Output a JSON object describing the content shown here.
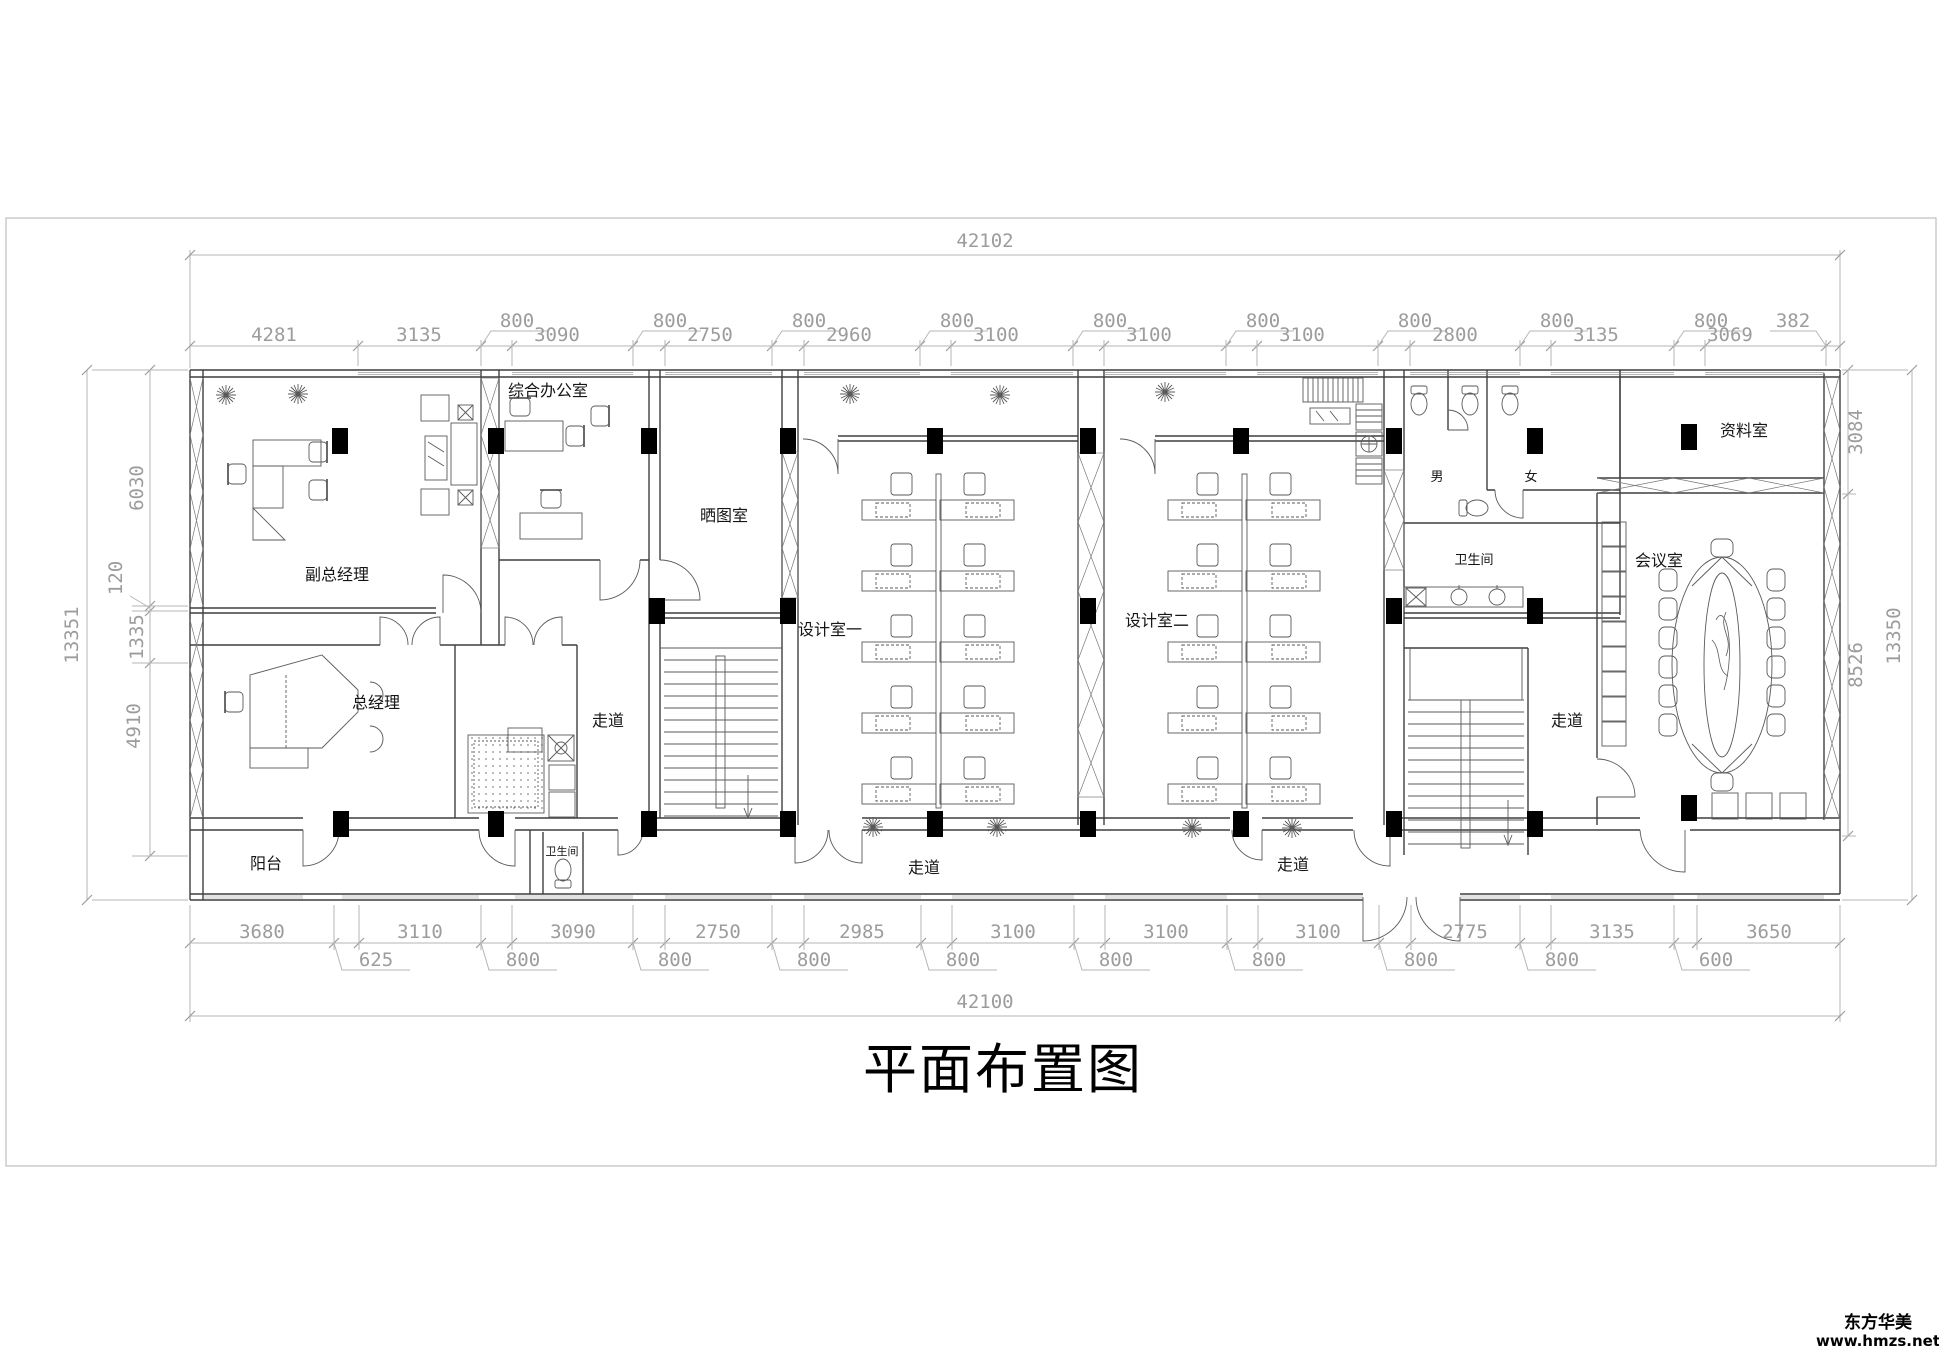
{
  "title": "平面布置图",
  "watermark": {
    "name": "东方华美",
    "url": "www.hmzs.net"
  },
  "dims": {
    "top_total": "42102",
    "bottom_total": "42100",
    "top_main": [
      "4281",
      "3135",
      "3090",
      "2750",
      "2960",
      "3100",
      "3100",
      "3100",
      "2800",
      "3135",
      "3069",
      "382"
    ],
    "top_sub": [
      "800",
      "800",
      "800",
      "800",
      "800",
      "800",
      "800",
      "800",
      "800"
    ],
    "bottom_main": [
      "3680",
      "3110",
      "3090",
      "2750",
      "2985",
      "3100",
      "3100",
      "3100",
      "2775",
      "3135",
      "3650"
    ],
    "bottom_sub": [
      "625",
      "800",
      "800",
      "800",
      "800",
      "800",
      "800",
      "800",
      "800",
      "600"
    ],
    "left_total": "13351",
    "left_chain": [
      "6030",
      "120",
      "1335",
      "4910"
    ],
    "right_chain": [
      "3084",
      "8526"
    ],
    "right_total": "13350"
  },
  "rooms": {
    "deputy_gm": "副总经理",
    "general_office": "综合办公室",
    "gm": "总经理",
    "balcony": "阳台",
    "blueprint": "晒图室",
    "design1": "设计室一",
    "design2": "设计室二",
    "archive": "资料室",
    "meeting": "会议室",
    "restroom": "卫生间",
    "restroom_small": "卫生间",
    "male": "男",
    "female": "女"
  },
  "corridors": [
    "走道",
    "走道",
    "走道",
    "走道"
  ]
}
